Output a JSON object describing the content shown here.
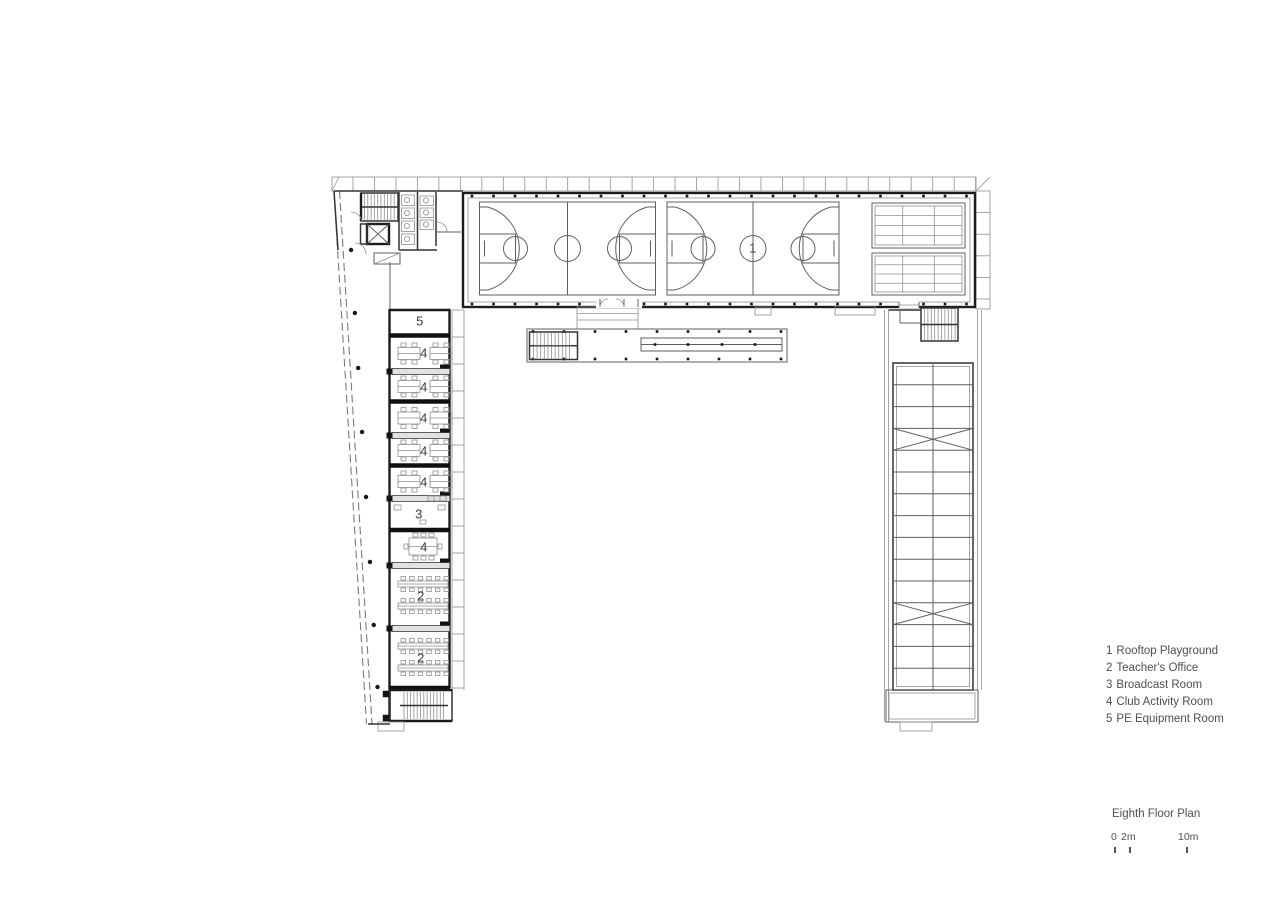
{
  "plan": {
    "room_labels": [
      {
        "room": "rooftop-playground",
        "text": "1"
      },
      {
        "room": "pe-equipment-room",
        "text": "5"
      },
      {
        "room": "club-activity-room-1",
        "text": "4"
      },
      {
        "room": "club-activity-room-2",
        "text": "4"
      },
      {
        "room": "club-activity-room-3",
        "text": "4"
      },
      {
        "room": "club-activity-room-4",
        "text": "4"
      },
      {
        "room": "club-activity-room-5",
        "text": "4"
      },
      {
        "room": "broadcast-room",
        "text": "3"
      },
      {
        "room": "club-activity-room-6",
        "text": "4"
      },
      {
        "room": "teachers-office-1",
        "text": "2"
      },
      {
        "room": "teachers-office-2",
        "text": "2"
      }
    ]
  },
  "legend": {
    "items": [
      {
        "num": "1",
        "text": "Rooftop Playground"
      },
      {
        "num": "2",
        "text": "Teacher's Office"
      },
      {
        "num": "3",
        "text": "Broadcast Room"
      },
      {
        "num": "4",
        "text": "Club Activity Room"
      },
      {
        "num": "5",
        "text": "PE Equipment Room"
      }
    ]
  },
  "title_block": {
    "title": "Eighth Floor Plan",
    "scale_bar": {
      "zero": "0",
      "two": "2m",
      "ten": "10m"
    }
  }
}
